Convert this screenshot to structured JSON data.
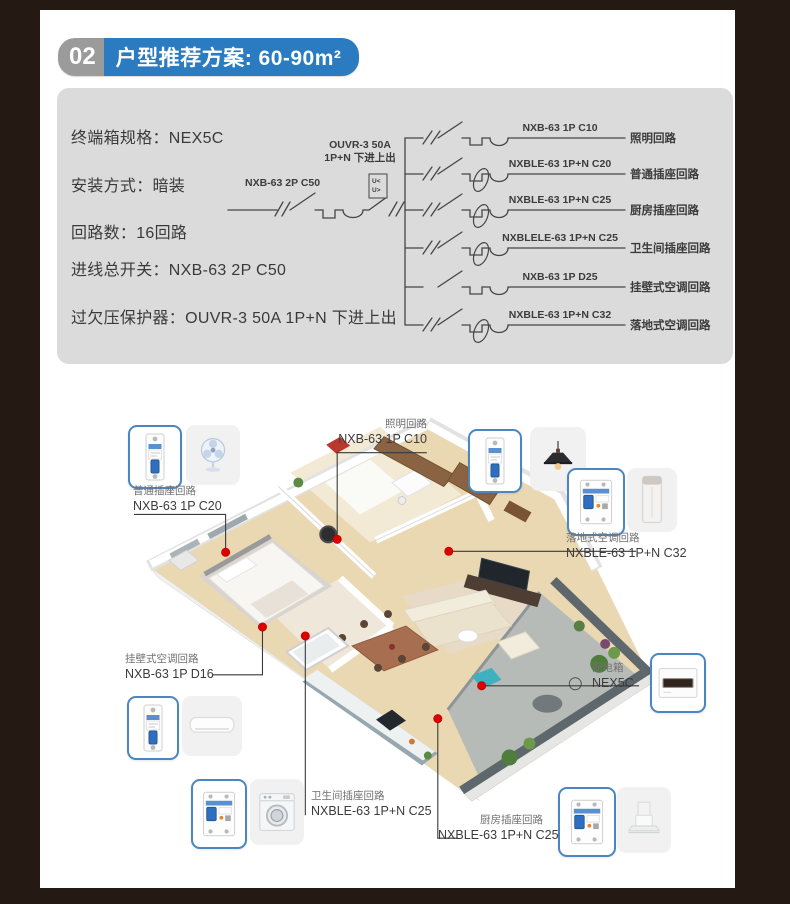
{
  "header": {
    "number": "02",
    "title": "户型推荐方案: 60-90m²"
  },
  "specs": {
    "items": [
      "终端箱规格：NEX5C",
      "安装方式：暗装",
      "回路数：16回路",
      "进线总开关：NXB-63 2P C50",
      "过欠压保护器：OUVR-3 50A 1P+N 下进上出"
    ]
  },
  "diagram": {
    "incoming": {
      "breaker_label": "NXB-63 2P C50",
      "protector_label_line1": "OUVR-3 50A",
      "protector_label_line2": "1P+N 下进上出",
      "protector_box_line1": "U<",
      "protector_box_line2": "U>"
    },
    "branches": [
      {
        "model": "NXB-63 1P C10",
        "name": "照明回路",
        "rcd": false
      },
      {
        "model": "NXBLE-63 1P+N C20",
        "name": "普通插座回路",
        "rcd": true
      },
      {
        "model": "NXBLE-63 1P+N C25",
        "name": "厨房插座回路",
        "rcd": true
      },
      {
        "model": "NXBLELE-63 1P+N C25",
        "name": "卫生间插座回路",
        "rcd": true
      },
      {
        "model": "NXB-63 1P D25",
        "name": "挂壁式空调回路",
        "rcd": false
      },
      {
        "model": "NXBLE-63 1P+N C32",
        "name": "落地式空调回路",
        "rcd": true
      }
    ]
  },
  "floorplan": {
    "callouts": [
      {
        "id": "lighting",
        "circuit": "照明回路",
        "model": "NXB-63 1P C10"
      },
      {
        "id": "socket",
        "circuit": "普通插座回路",
        "model": "NXB-63 1P C20"
      },
      {
        "id": "floor_ac",
        "circuit": "落地式空调回路",
        "model": "NXBLE-63 1P+N C32"
      },
      {
        "id": "wall_ac",
        "circuit": "挂壁式空调回路",
        "model": "NXB-63 1P D16"
      },
      {
        "id": "bathroom",
        "circuit": "卫生间插座回路",
        "model": "NXBLE-63 1P+N C25"
      },
      {
        "id": "kitchen",
        "circuit": "厨房插座回路",
        "model": "NXBLE-63 1P+N C25"
      },
      {
        "id": "distribution_box",
        "circuit": "配电箱",
        "model": "NEX5C"
      }
    ]
  },
  "icons": {
    "breaker_1p": "breaker-1p-icon",
    "breaker_2p": "rcbo-2p-icon",
    "fan": "table-fan-icon",
    "pendant_lamp": "pendant-lamp-icon",
    "floor_ac": "floor-ac-icon",
    "wall_ac": "wall-ac-icon",
    "washing_machine": "washing-machine-icon",
    "range_hood": "range-hood-icon",
    "distribution_box": "distribution-box-icon"
  },
  "colors": {
    "frame_dark": "#241a13",
    "accent_blue": "#2a7bc0",
    "badge_gray": "#9b9b9b",
    "panel_gray": "#dbdbdb",
    "callout_border": "#4a86c2",
    "dot_red": "#dd0000"
  }
}
